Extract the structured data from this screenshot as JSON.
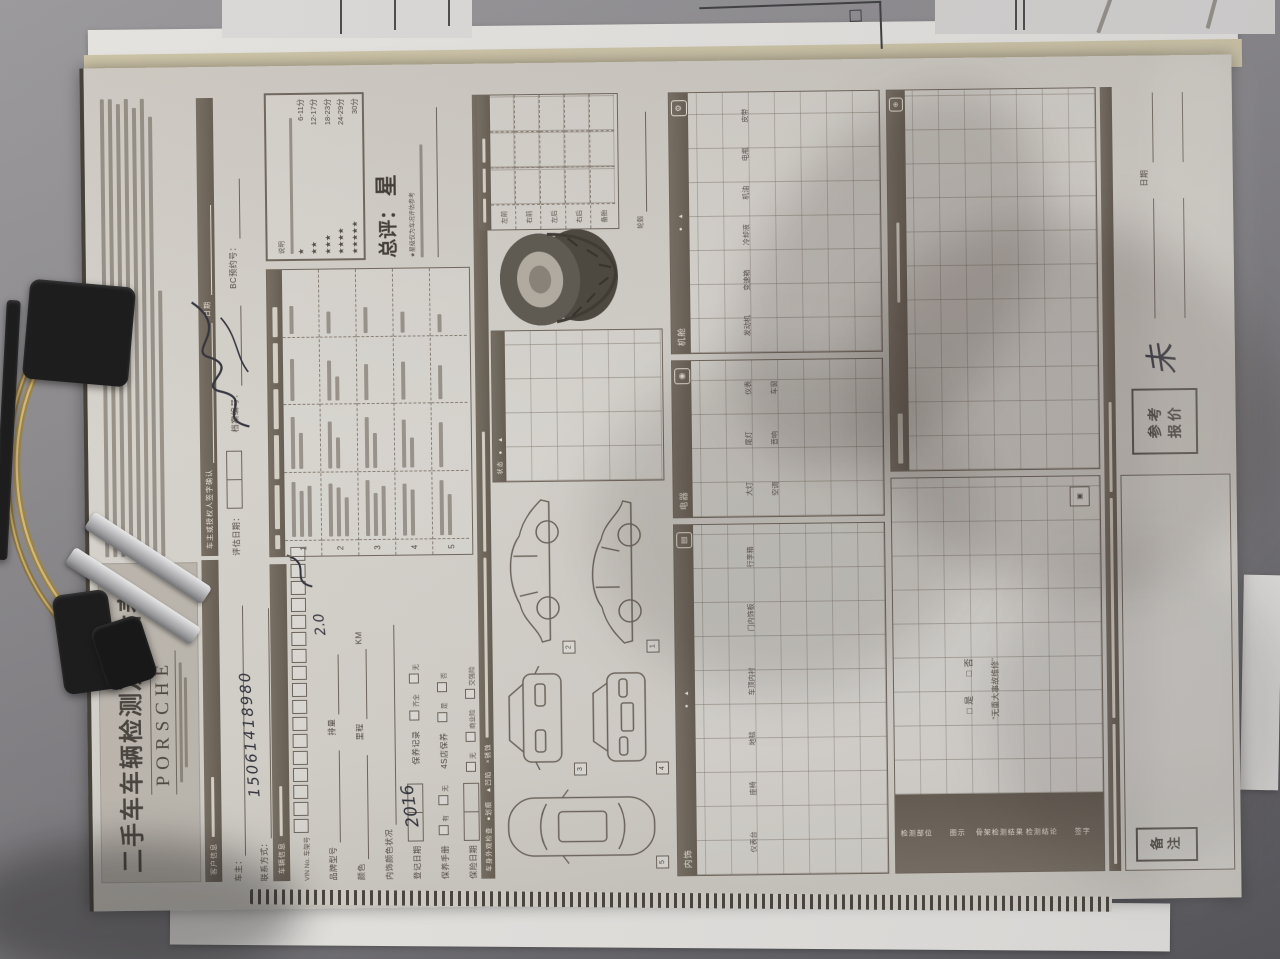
{
  "form": {
    "title": "二手车车辆检测及评估表",
    "brand": "PORSCHE",
    "customer": {
      "section_label": "客户信息",
      "owner_label": "车主：",
      "contact_label": "联系方式：",
      "phone_handwritten": "15061418980"
    },
    "sign_row": {
      "sign_label": "车主或授权人签字确认",
      "date_label": "日期",
      "eval_date_label": "评估日期：",
      "file_no_label": "档案编号：",
      "ref_no_label": "BC预约号："
    },
    "vehicle": {
      "section_label": "车辆信息",
      "vin_label": "VIN No. 车架号",
      "brand_model_label": "品牌型号",
      "displacement_label": "排量",
      "displacement_value": "2.0",
      "color_label": "颜色",
      "mileage_label": "里程",
      "mileage_unit": "KM",
      "interior_label": "内饰颜色状况",
      "reg_date_label": "登记日期",
      "reg_date_value": "2016",
      "maintenance_label": "保养记录",
      "opt_complete": "齐全",
      "opt_none": "无",
      "handbook_label": "保养手册",
      "opt_yes": "有",
      "dealer_label": "4S店保养",
      "opt_shi": "是",
      "opt_fou": "否",
      "insurance_date_label": "保险日期",
      "ins_none": "无",
      "ins_commercial": "商业险",
      "ins_compulsory": "交强险"
    },
    "rating": {
      "box_title": "说明",
      "scale": [
        {
          "stars": "★",
          "range": "6-11分"
        },
        {
          "stars": "★★",
          "range": "12-17分"
        },
        {
          "stars": "★★★",
          "range": "18-23分"
        },
        {
          "stars": "★★★★",
          "range": "24-29分"
        },
        {
          "stars": "★★★★★",
          "range": "30分"
        }
      ],
      "overall_label": "总评：",
      "overall_value": "星",
      "footnote": "★星级仅为车况评估参考"
    },
    "score_table": {
      "row_numbers": [
        "1",
        "2",
        "3",
        "4",
        "5"
      ]
    },
    "exterior": {
      "legend_title": "车身外观检查",
      "legend_symbols": "●划痕　▲凹陷　×锈蚀",
      "diagram_numbers": [
        "1",
        "2",
        "3",
        "4",
        "5"
      ],
      "status_label": "状态",
      "status_symbols": "●　▲"
    },
    "tires": {
      "rows": [
        "左前",
        "右前",
        "左后",
        "右后",
        "备胎"
      ],
      "wheel_label": "轮毂"
    },
    "inspect": {
      "status_label": "状态",
      "status_symbols": "●　▲",
      "sections": [
        {
          "title": "内饰",
          "items": [
            "仪表台",
            "座椅",
            "地毯",
            "车顶内衬",
            "门内饰板",
            "行李箱"
          ]
        },
        {
          "title": "电器",
          "items": [
            "大灯",
            "尾灯",
            "仪表",
            "空调",
            "音响",
            "车窗"
          ]
        },
        {
          "title": "机舱",
          "items": [
            "发动机",
            "变速箱",
            "冷却液",
            "机油",
            "电瓶",
            "皮带"
          ]
        }
      ],
      "frame": {
        "checkbox_line": "□ 是　　□ 否",
        "quote_line": "“无重大事故维修”",
        "column_labels": [
          "检测部位",
          "图示",
          "骨架检测结果",
          "检测结论",
          "签字"
        ]
      }
    },
    "bottom": {
      "notes_label": "备注",
      "date_label": "日期",
      "quote_box_line1": "参考",
      "quote_box_line2": "报价",
      "mark_handwritten": "未"
    }
  }
}
